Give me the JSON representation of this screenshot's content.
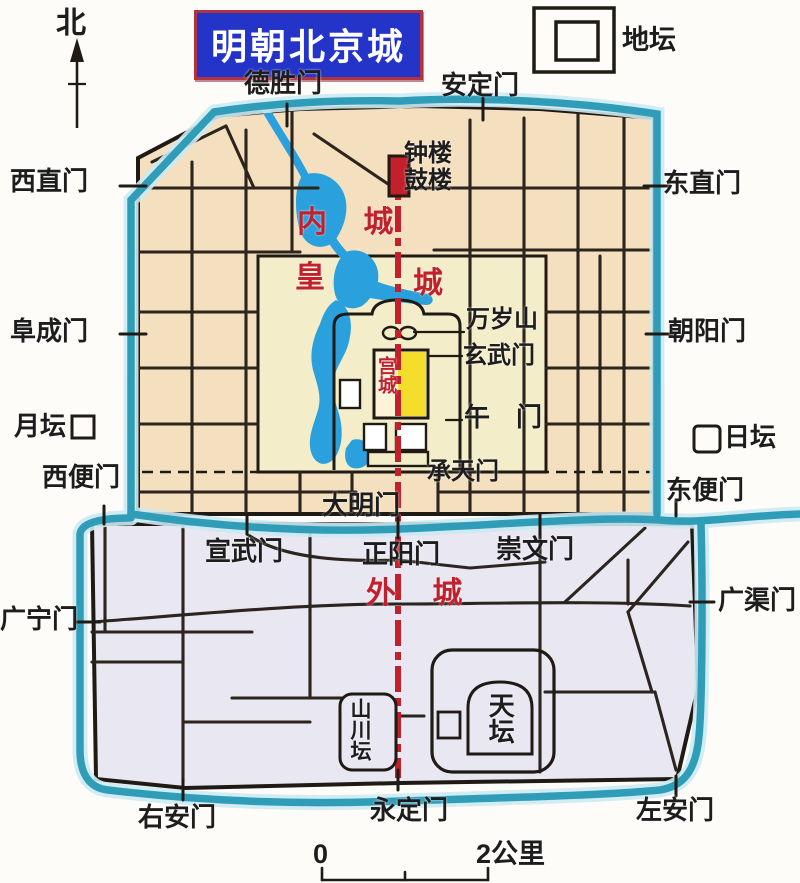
{
  "title": "明朝北京城",
  "north": {
    "label": "北"
  },
  "legend": {
    "ditan": "地坛"
  },
  "regions": {
    "inner_city": "内 城",
    "imperial_left": "皇",
    "imperial_right": "城",
    "palace_city": "宫城",
    "outer_city": "外 城"
  },
  "gates": {
    "deshengmen": "德胜门",
    "andingmen": "安定门",
    "xizhimen": "西直门",
    "dongzhimen": "东直门",
    "fuchengmen": "阜成门",
    "chaoyangmen": "朝阳门",
    "xibianmen": "西便门",
    "dongbianmen": "东便门",
    "xuanwumen_south": "宣武门",
    "zhengyangmen": "正阳门",
    "chongwenmen": "崇文门",
    "guangningmen": "广宁门",
    "guangqumen": "广渠门",
    "youanmen": "右安门",
    "yongdingmen": "永定门",
    "zuoanmen": "左安门"
  },
  "landmarks": {
    "zhonglou": "钟楼",
    "gulou": "鼓楼",
    "wansuishan": "万岁山",
    "xuanwumen_palace": "玄武门",
    "wumen": "午　门",
    "chengtianmen": "承天门",
    "damingmen": "大明门",
    "yuetan": "月坛",
    "ritan": "日坛",
    "shanchuantan": "山川坛",
    "tiantan": "天坛"
  },
  "scale_bar": {
    "start": "0",
    "end": "2公里"
  },
  "colors": {
    "title_bg": "#2433c8",
    "title_border": "#b03340",
    "title_text": "#ffffff",
    "inner_city": "#f4dfbe",
    "imperial_city": "#f3edca",
    "palace_yellow": "#f4dd2b",
    "palace_pale": "#fcf3d8",
    "outer_city": "#e9e7f2",
    "water": "#2aa0dc",
    "moat": "#2f9db8",
    "moat_halo": "#cdeaf2",
    "street": "#2b251e",
    "wall": "#1f1a14",
    "axis_red": "#c3202c",
    "label_red": "#c3202c",
    "white": "#ffffff"
  }
}
